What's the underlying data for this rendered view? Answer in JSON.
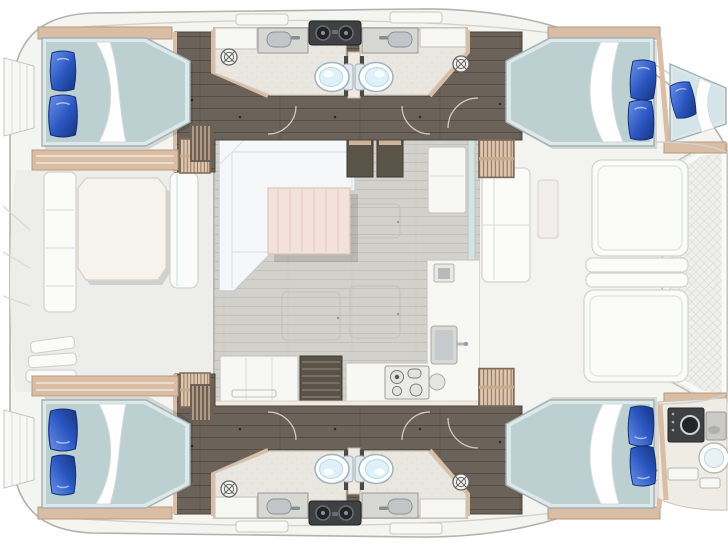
{
  "meta": {
    "title": "Catamaran yacht interior layout — top-down floor plan",
    "view": "top-down",
    "vessel_type": "sailing catamaran"
  },
  "colors": {
    "hull_fill": "#f4f4f1",
    "hull_line": "#b2b2ae",
    "deck": "#ededeb",
    "deck_line": "#d2d2ce",
    "salon_floor": "#d2d1cc",
    "cabin_floor": "#6b6359",
    "head_floor": "#eae7e0",
    "trim": "#d9bda4",
    "trim_dark": "#8d7a64",
    "stair": "#e0c6ae",
    "bed_frame": "#dfe8e9",
    "duvet": "#bccfd1",
    "duvet_light": "#d5e4e8",
    "sheet": "#ffffff",
    "pillow_blue": "#2a56c0",
    "pillow_blue_dark": "#17357f",
    "sofa": "#f5f7f8",
    "sofa_line": "#c9cdd2",
    "table_wood": "#f2e2da",
    "counter": "#f7f7f4",
    "counter_line": "#c9c8c3",
    "dark_cabinet": "#5a5348",
    "appliance": "#3e4043",
    "steel": "#d7d7d3",
    "window": "#d5e2e2",
    "furn_white": "#fbfbf9",
    "mesh_line": "#d6d6d1"
  },
  "features": {
    "cabins": [
      {
        "id": "aft-port-cabin",
        "bed": "double",
        "pillows": 2
      },
      {
        "id": "forward-port-cabin",
        "bed": "double",
        "pillows": 2
      },
      {
        "id": "aft-starboard-cabin",
        "bed": "double",
        "pillows": 2
      },
      {
        "id": "forward-starboard-cabin",
        "bed": "double",
        "pillows": 2
      },
      {
        "id": "port-forepeak",
        "bed": "single",
        "pillows": 1
      },
      {
        "id": "starboard-forepeak",
        "use": "utility-crew-area"
      }
    ],
    "heads": [
      {
        "id": "port-aft-head",
        "fixtures": [
          "toilet",
          "sink-vanity",
          "shower-drain"
        ]
      },
      {
        "id": "port-forward-head",
        "fixtures": [
          "toilet",
          "sink-vanity",
          "shower-drain"
        ]
      },
      {
        "id": "starboard-aft-head",
        "fixtures": [
          "toilet",
          "sink-vanity",
          "shower-drain"
        ]
      },
      {
        "id": "starboard-forward-head",
        "fixtures": [
          "toilet",
          "sink-vanity",
          "shower-drain"
        ]
      }
    ],
    "salon": [
      "u-shaped-sofa",
      "coffee-table",
      "nav-cabinet",
      "refrigerator",
      "galley-counter",
      "galley-sink",
      "prep-sink",
      "stove",
      "storage-steps",
      "sideboard"
    ],
    "aft_cockpit": [
      "dining-table",
      "bench-seat",
      "side-bench",
      "transom-steps"
    ],
    "foredeck": [
      "forward-cockpit-seats",
      "sun-cushions",
      "trampoline"
    ],
    "stairs": [
      "port-aft-stairs",
      "port-forward-stairs",
      "starboard-aft-stairs",
      "starboard-forward-stairs"
    ]
  }
}
